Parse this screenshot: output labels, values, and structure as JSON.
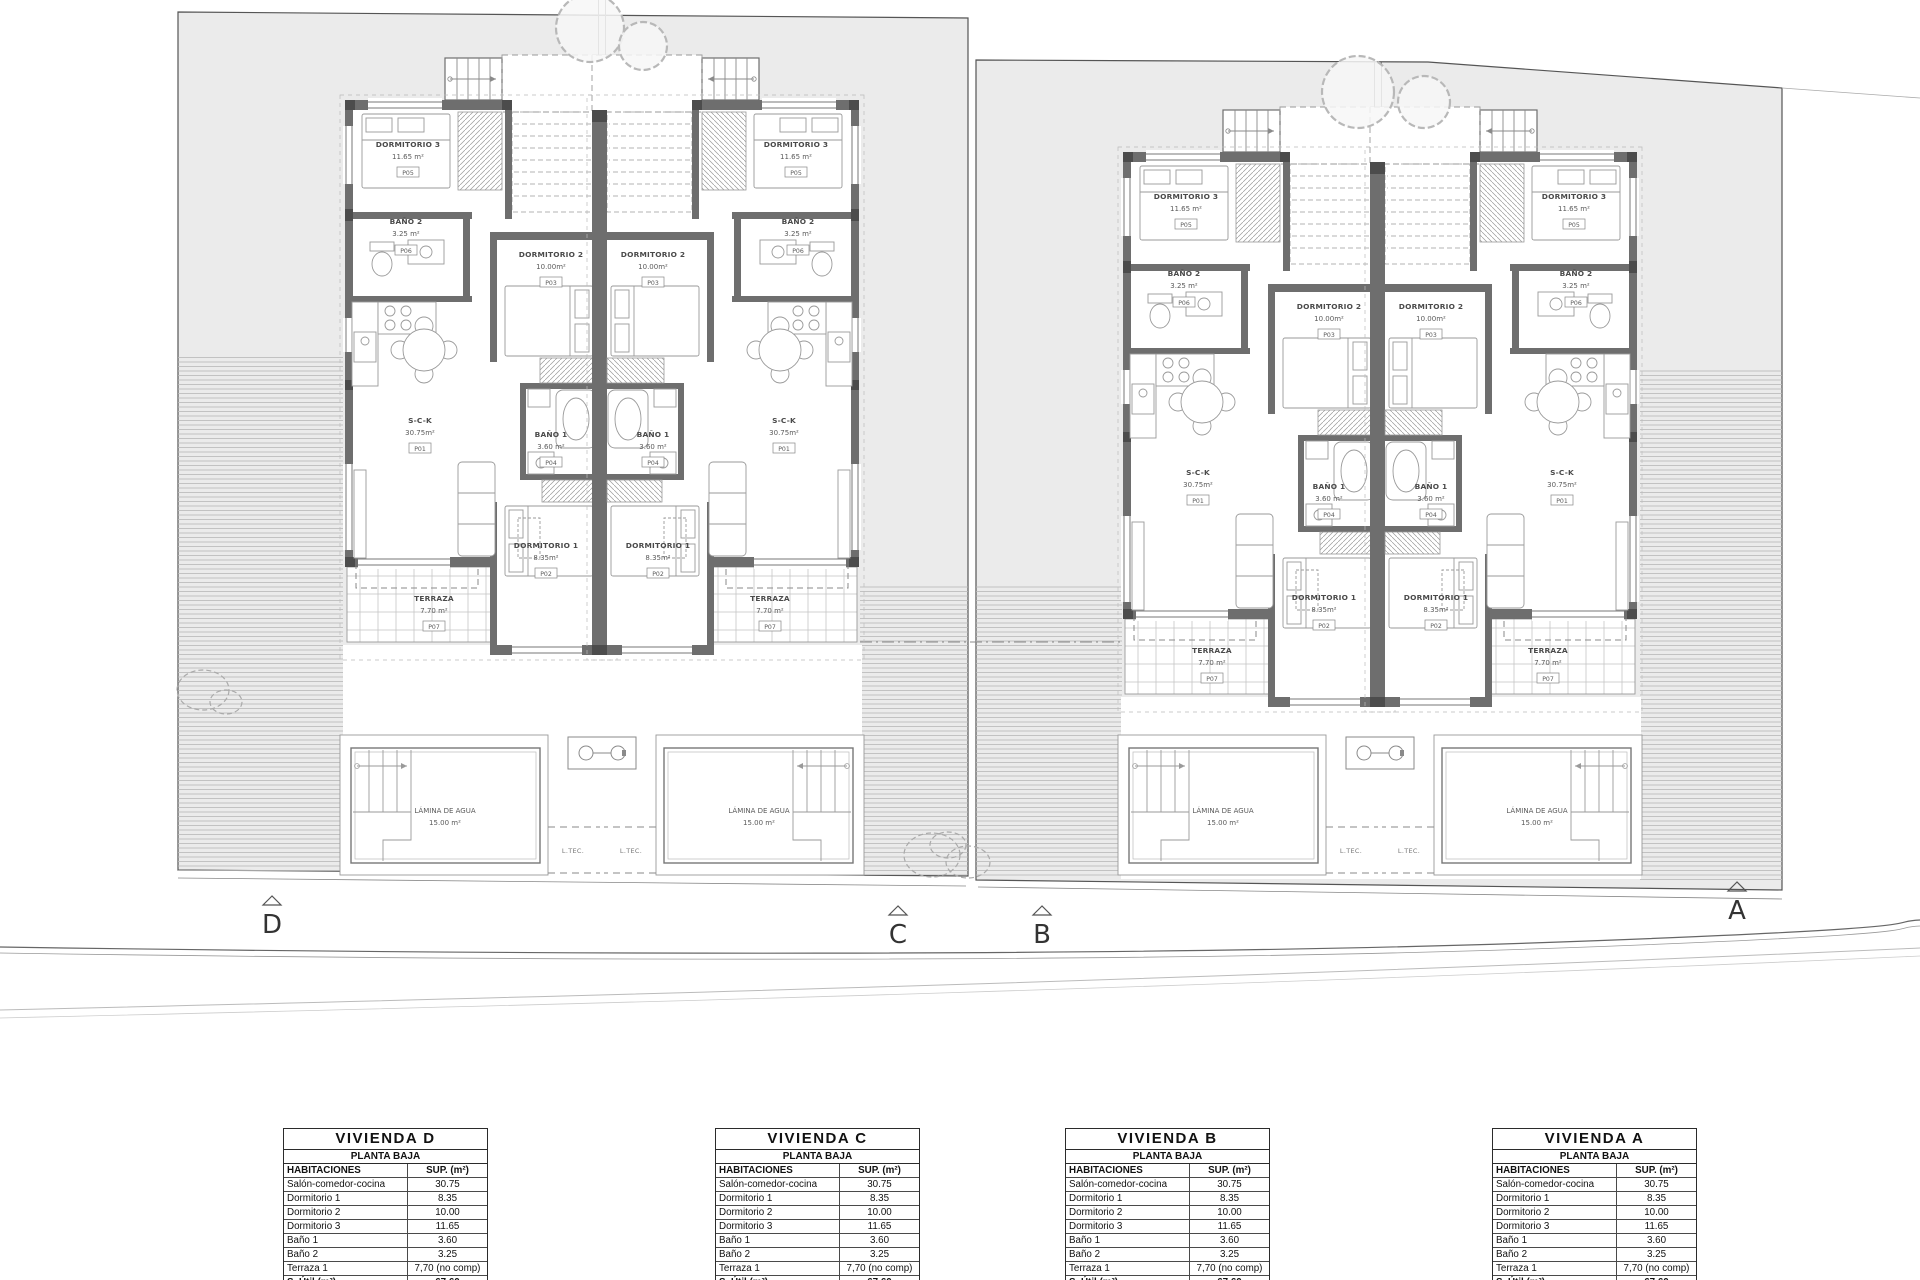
{
  "colors": {
    "site_fill": "#ebebeb",
    "wall_fill": "#6e6e6e",
    "boundary": "#555555"
  },
  "site": {
    "markers": [
      {
        "label": "D"
      },
      {
        "label": "C"
      },
      {
        "label": "B"
      },
      {
        "label": "A"
      }
    ],
    "rooms": {
      "dorm3": {
        "name": "DORMITORIO 3",
        "area": "11.65 m²",
        "tag": "P05"
      },
      "bano2": {
        "name": "BAÑO 2",
        "area": "3.25 m²",
        "tag": "P06"
      },
      "dorm2": {
        "name": "DORMITORIO 2",
        "area": "10.00m²",
        "tag": "P03"
      },
      "sck": {
        "name": "S-C-K",
        "area": "30.75m²",
        "tag": "P01"
      },
      "bano1": {
        "name": "BAÑO 1",
        "area": "3.60 m²",
        "tag": "P04"
      },
      "dorm1": {
        "name": "DORMITORIO 1",
        "area": "8.35m²",
        "tag": "P02"
      },
      "terraza": {
        "name": "TERRAZA",
        "area": "7.70 m²",
        "tag": "P07"
      },
      "pool": {
        "name": "LÁMINA DE AGUA",
        "area": "15.00 m²"
      },
      "ltec": "L.TEC."
    }
  },
  "tables": [
    {
      "title": "VIVIENDA D",
      "subtitle": "PLANTA BAJA",
      "col1": "HABITACIONES",
      "col2": "SUP. (m²)",
      "rows": [
        [
          "Salón-comedor-cocina",
          "30.75"
        ],
        [
          "Dormitorio 1",
          "8.35"
        ],
        [
          "Dormitorio 2",
          "10.00"
        ],
        [
          "Dormitorio 3",
          "11.65"
        ],
        [
          "Baño 1",
          "3.60"
        ],
        [
          "Baño 2",
          "3.25"
        ],
        [
          "Terraza 1",
          "7,70 (no comp)"
        ]
      ],
      "total_label": "S. Útil (m²)",
      "total": "67.60"
    },
    {
      "title": "VIVIENDA C",
      "subtitle": "PLANTA BAJA",
      "col1": "HABITACIONES",
      "col2": "SUP. (m²)",
      "rows": [
        [
          "Salón-comedor-cocina",
          "30.75"
        ],
        [
          "Dormitorio 1",
          "8.35"
        ],
        [
          "Dormitorio 2",
          "10.00"
        ],
        [
          "Dormitorio 3",
          "11.65"
        ],
        [
          "Baño 1",
          "3.60"
        ],
        [
          "Baño 2",
          "3.25"
        ],
        [
          "Terraza 1",
          "7,70 (no comp)"
        ]
      ],
      "total_label": "S. Útil (m²)",
      "total": "67.60"
    },
    {
      "title": "VIVIENDA B",
      "subtitle": "PLANTA BAJA",
      "col1": "HABITACIONES",
      "col2": "SUP. (m²)",
      "rows": [
        [
          "Salón-comedor-cocina",
          "30.75"
        ],
        [
          "Dormitorio 1",
          "8.35"
        ],
        [
          "Dormitorio 2",
          "10.00"
        ],
        [
          "Dormitorio 3",
          "11.65"
        ],
        [
          "Baño 1",
          "3.60"
        ],
        [
          "Baño 2",
          "3.25"
        ],
        [
          "Terraza 1",
          "7,70 (no comp)"
        ]
      ],
      "total_label": "S. Útil (m²)",
      "total": "67.60"
    },
    {
      "title": "VIVIENDA A",
      "subtitle": "PLANTA BAJA",
      "col1": "HABITACIONES",
      "col2": "SUP. (m²)",
      "rows": [
        [
          "Salón-comedor-cocina",
          "30.75"
        ],
        [
          "Dormitorio 1",
          "8.35"
        ],
        [
          "Dormitorio 2",
          "10.00"
        ],
        [
          "Dormitorio 3",
          "11.65"
        ],
        [
          "Baño 1",
          "3.60"
        ],
        [
          "Baño 2",
          "3.25"
        ],
        [
          "Terraza 1",
          "7,70 (no comp)"
        ]
      ],
      "total_label": "S. Útil (m²)",
      "total": "67.60"
    }
  ]
}
